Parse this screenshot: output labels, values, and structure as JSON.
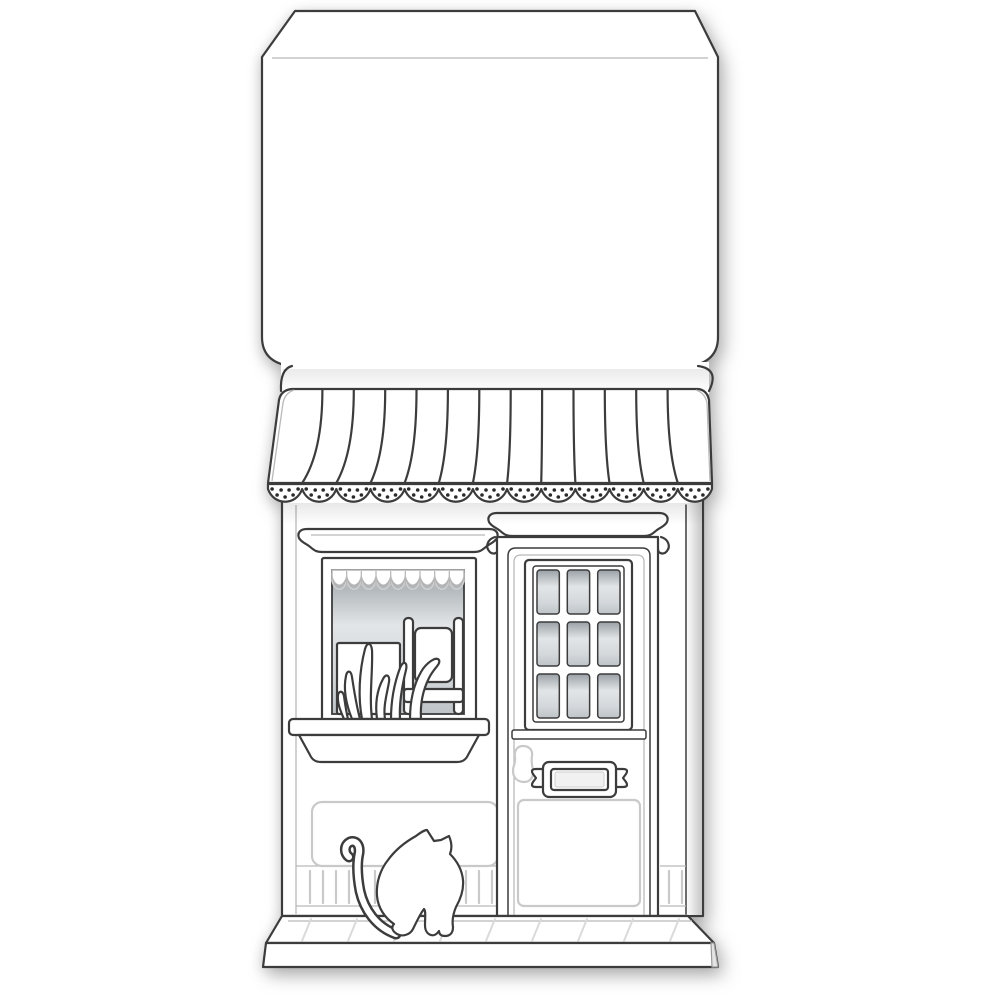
{
  "meta": {
    "description": "Line-art die-cut greeting card: storefront with striped awning, display window, paneled door and sitting cat, with an open envelope flap above"
  },
  "colors": {
    "paper": "#ffffff",
    "outline": "#3c3c3c",
    "emboss": "#c9c9c9",
    "glass_dark": "#a2a9ae",
    "glass_light": "#e0e3e5",
    "dot": "#2a2a2a",
    "shadow": "rgba(0,0,0,0.28)"
  },
  "card_flap": {
    "name": "envelope-flap",
    "fold_lines": 2
  },
  "awning": {
    "stripes": 13,
    "scallops": 13,
    "dots_per_scallop": 7
  },
  "shop_window": {
    "valance_scallops": 9,
    "valance_ribs": 8,
    "items": [
      "canvas-box",
      "chair",
      "grass"
    ]
  },
  "door": {
    "pane_rows": 3,
    "pane_cols": 3,
    "hardware": [
      "door-handle",
      "letter-plaque"
    ]
  },
  "vent": {
    "left_slats": 15,
    "right_slats": 3
  },
  "porch": {
    "paver_joints": 9
  },
  "cat": {
    "pose": "sitting",
    "facing": "right"
  }
}
